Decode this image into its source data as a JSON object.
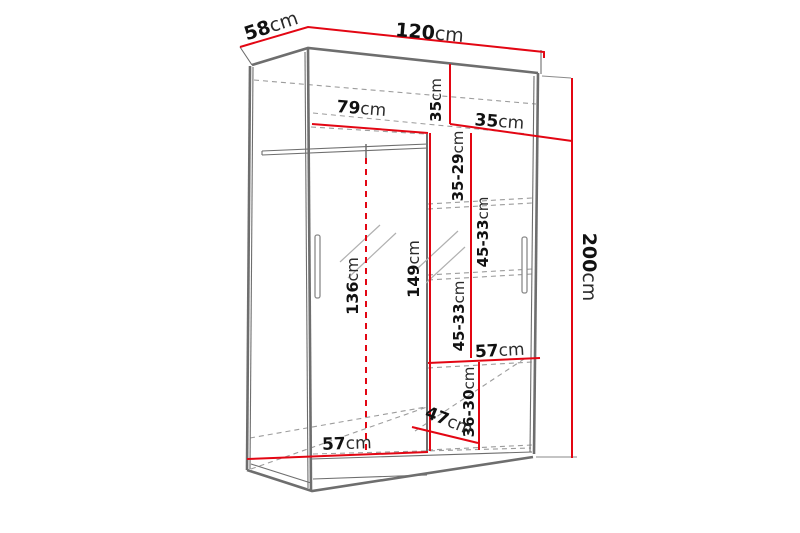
{
  "diagram": {
    "subject": "sliding-door wardrobe technical dimension drawing",
    "dimensions": {
      "width": {
        "value": "120",
        "unit": "cm"
      },
      "depth": {
        "value": "58",
        "unit": "cm"
      },
      "height": {
        "value": "200",
        "unit": "cm"
      },
      "left_section_width": {
        "value": "79",
        "unit": "cm"
      },
      "top_section_height": {
        "value": "35",
        "unit": "cm"
      },
      "right_section_width": {
        "value": "35",
        "unit": "cm"
      },
      "right_gap_top": {
        "value": "35-29",
        "unit": "cm"
      },
      "right_gap_upper": {
        "value": "45-33",
        "unit": "cm"
      },
      "right_gap_lower": {
        "value": "45-33",
        "unit": "cm"
      },
      "right_gap_bottom": {
        "value": "36-30",
        "unit": "cm"
      },
      "hanging_space_height": {
        "value": "136",
        "unit": "cm"
      },
      "left_section_height": {
        "value": "149",
        "unit": "cm"
      },
      "right_shelf_width": {
        "value": "57",
        "unit": "cm"
      },
      "bottom_shelf_depth": {
        "value": "47",
        "unit": "cm"
      },
      "bottom_interior_width": {
        "value": "57",
        "unit": "cm"
      }
    },
    "colors": {
      "dimension_line": "#e30613",
      "outline": "#6e6e6e",
      "hidden_line": "#9c9c9c",
      "label": "#111111",
      "background": "#ffffff"
    }
  }
}
